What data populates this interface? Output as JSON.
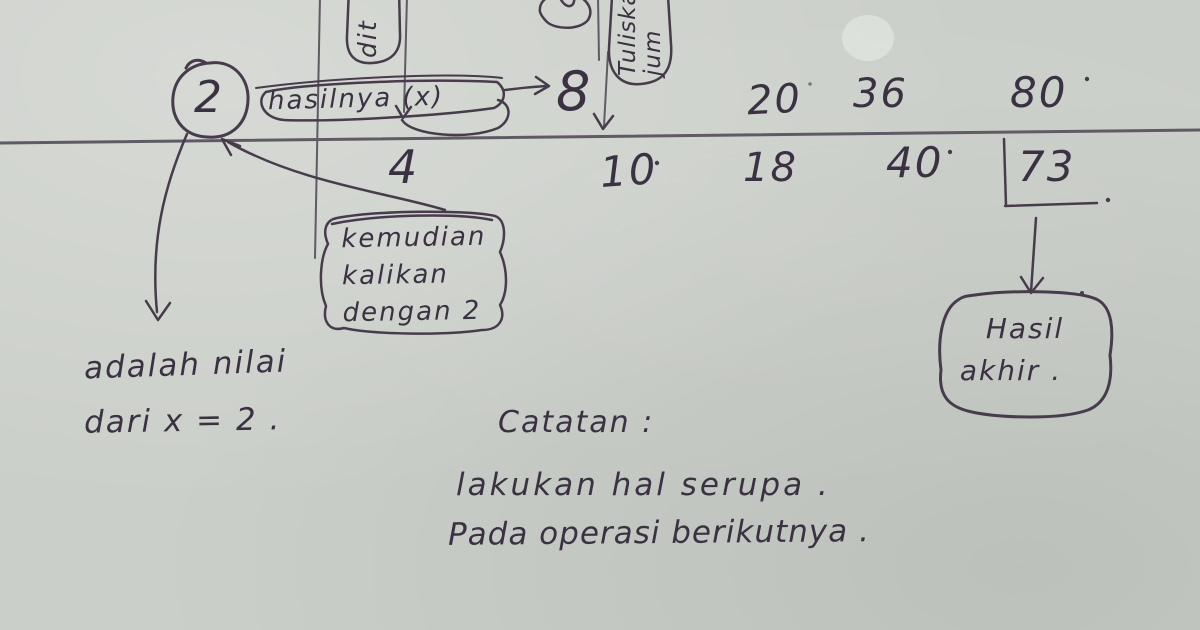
{
  "colors": {
    "ink": "#473c4b",
    "ruled_line": "#5f5a63",
    "paper": "#cbcfc9"
  },
  "table": {
    "circled_multiplier": "2",
    "operation_label": "hasilnya (x)",
    "top_values": [
      "8",
      "20",
      "36",
      "80"
    ],
    "bottom_values": [
      "4",
      "10",
      "18",
      "40",
      "73"
    ]
  },
  "labels": {
    "rotated_left": "dit",
    "rotated_right_line1": "Tuliskan",
    "rotated_right_line2": "jum",
    "multiply_note_line1": "kemudian",
    "multiply_note_line2": "kalikan",
    "multiply_note_line3": "dengan 2",
    "x_note_line1": "adalah nilai",
    "x_note_line2": "dari x = 2 .",
    "final_note_line1": "Hasil",
    "final_note_line2": "akhir .",
    "caption_heading": "Catatan :",
    "caption_line1": "lakukan hal serupa .",
    "caption_line2": "Pada operasi berikutnya ."
  }
}
